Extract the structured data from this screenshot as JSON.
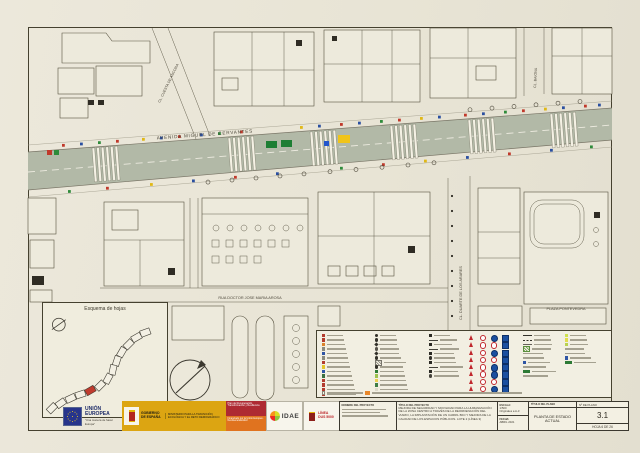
{
  "map": {
    "labels": {
      "avenue": "AVENIDA MIGUEL DE CERVANTES",
      "street_diagonal": "CL. CUESTA DE ANCORA",
      "street_top_right": "CL. BAIONA",
      "street_vertical": "CL. DUARTE DE LOS ARARES",
      "street_bottom": "RUA DOCTOR JOSE MARIA AROSA",
      "plaza": "PLAZA PONTEVEDRA"
    },
    "inset_title": "Esquema de hojas",
    "road_color": "#b2b9a7",
    "sign_dot_colors": [
      "#c0392b",
      "#2a4fa0",
      "#2e8b3a",
      "#c0392b",
      "#e0b816",
      "#2a4fa0"
    ]
  },
  "legend": {
    "columns": [
      {
        "x": 5,
        "items": [
          [
            "sq",
            "#b23b2e"
          ],
          [
            "sq",
            "#b23b2e"
          ],
          [
            "sq",
            "#d9822b"
          ],
          [
            "sq",
            "#8a8a7e"
          ],
          [
            "sq",
            "#2f55a4"
          ],
          [
            "sq",
            "#8a8a7e"
          ],
          [
            "sq",
            "#b23b2e"
          ],
          [
            "sq",
            "#e4c42a"
          ],
          [
            "sq",
            "#2f55a4"
          ],
          [
            "sq",
            "#3c6e3f"
          ],
          [
            "sq",
            "#b23b2e"
          ],
          [
            "sq",
            "#b23b2e"
          ],
          [
            "sq",
            "#b23b2e"
          ],
          [
            "sq",
            "#b23b2e"
          ]
        ]
      },
      {
        "x": 58,
        "items": [
          [
            "dot",
            "#33312a"
          ],
          [
            "dot",
            "#33312a"
          ],
          [
            "dia",
            "#33312a"
          ],
          [
            "dot",
            "#55524a"
          ],
          [
            "dia",
            "#33312a"
          ],
          [
            "dot",
            "#33312a"
          ],
          [
            "hatch",
            "#77746a"
          ],
          [
            "dot",
            "#33312a"
          ],
          [
            "sq",
            "#2d7a35"
          ],
          [
            "sq",
            "#9cc24e"
          ],
          [
            "sq",
            "#eccf4e"
          ],
          [
            "sq",
            "#3f7d46"
          ],
          [
            "sq",
            "#dedacb"
          ]
        ]
      },
      {
        "x": 112,
        "items": [
          [
            "sq",
            "#2b2a24"
          ],
          [
            "dash",
            "#44423a"
          ],
          [
            "sq",
            "#2b2a24"
          ],
          [
            "dash",
            "#44423a"
          ],
          [
            "sq",
            "#2b2a24"
          ],
          [
            "dot",
            "#33312a"
          ],
          [
            "sq",
            "#2b2a24"
          ],
          [
            "dash",
            "#44423a"
          ],
          [
            "sq",
            "#2b2a24"
          ],
          [
            "dot",
            "#44423a"
          ]
        ]
      },
      {
        "x": 206,
        "items": [
          [
            "dash",
            "#33312a"
          ],
          [
            "dashdot",
            "#33312a"
          ],
          [
            "dash",
            "#66635a"
          ],
          [
            "hatch",
            "#5a8f3c"
          ],
          [
            "bar",
            "#a5a190"
          ],
          [
            "bar",
            "#a5a190"
          ],
          [
            "sq",
            "#2f55a4"
          ],
          [
            "bar",
            "#a5a190"
          ],
          [
            "rectg",
            "#2d7a35"
          ],
          [
            "bar",
            "#a5a190"
          ]
        ]
      },
      {
        "x": 248,
        "items": [
          [
            "sq",
            "#cfe24e"
          ],
          [
            "sq",
            "#e2dc4a"
          ],
          [
            "sq",
            "#b9d24e"
          ],
          [
            "bar",
            "#a5a190"
          ],
          [
            "bar",
            "#a5a190"
          ],
          [
            "sq",
            "#2f55a4"
          ],
          [
            "rectg",
            "#2d7a35"
          ]
        ]
      }
    ],
    "signs": [
      [
        "tri",
        "cirR",
        "cirB",
        "sqB"
      ],
      [
        "tri",
        "cirR",
        "cirR",
        "sqB"
      ],
      [
        "tri",
        "cirR",
        "cirB",
        "sqB"
      ],
      [
        "tri",
        "cirR",
        "cirR",
        "sqB"
      ],
      [
        "tri",
        "cirR",
        "cirB",
        "sqB"
      ],
      [
        "tri",
        "cirR",
        "cirB",
        "sqB"
      ],
      [
        "tri",
        "cirR",
        "cirR",
        "sqB"
      ],
      [
        "tri",
        "cirR",
        "cirB",
        "sqB"
      ]
    ],
    "note_swatch_colors": [
      "#f5f2e6",
      "#e8872a"
    ]
  },
  "title_block": {
    "project_name_header": "NOMBRE DEL PROYECTO",
    "project_title_header": "TÍTULO DEL PROYECTO",
    "project_title": "MEJORA DE SEGURIDAD Y MOVILIDAD PARA LA HUMANIZACIÓN DE LA ZONA CENTRO A TRAVÉS DE LA REORDENACIÓN DEL VIARIO, LA IMPLANTACIÓN DE UN CARRIL BICI Y MEJORA DE LA CALIDAD DE LOS ESPACIOS PÚBLICOS. LOTE 2 (LÍNEA 3)",
    "scale_label": "ESCALA:",
    "scale_value": "1/500",
    "originals": "Originales a A-3",
    "date_label": "FECHA:",
    "date_value": "ABRIL 2021",
    "plan_title_header": "TÍTULO DEL PLANO",
    "plan_title": "PLANTA DE ESTADO ACTUAL",
    "plan_no_label": "Nº DE PLANO",
    "plan_no": "3.1",
    "sheet": "HOJA 6 DE 26"
  },
  "logos": {
    "eu_title": "UNIÓN EUROPEA",
    "eu_subtitle": "\"Una manera de hacer Europa\"",
    "gov_name": "GOBIERNO DE ESPAÑA",
    "ministry": "MINISTERIO PARA LA TRANSICIÓN ECOLÓGICA Y EL RETO DEMOGRÁFICO",
    "prtr": "Plan de Recuperación, Transformación y Resiliencia",
    "ngeu": "Financiado por la Unión Europea · NextGenerationEU",
    "idae": "IDAE",
    "dus_line1": "LÍNEA",
    "dus_line2": "DUS 5000"
  }
}
